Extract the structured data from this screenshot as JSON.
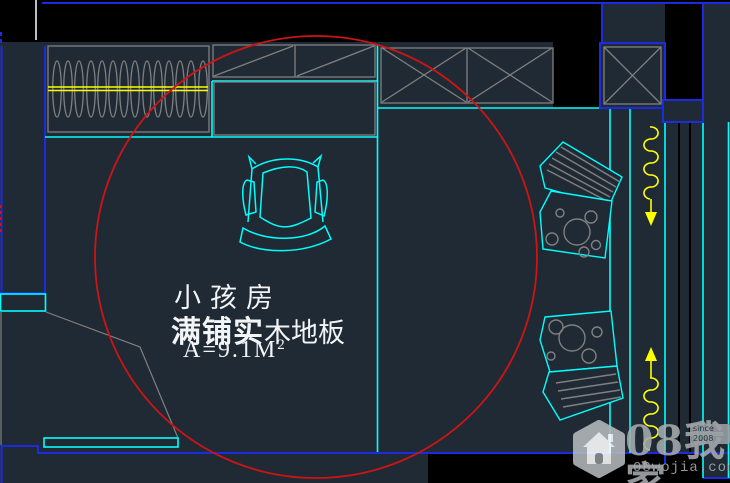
{
  "drawing": {
    "room_label": "小孩房",
    "floor_material_bold": "满铺实",
    "floor_material_rest": "木地板",
    "area_value": "A=9.1M",
    "area_exponent": "2"
  },
  "watermark": {
    "brand": "08我家",
    "site": "08wojia.com",
    "badge": "since 2008"
  },
  "icons": {
    "watermark_logo": "house-icon"
  },
  "colors": {
    "background": "#000000",
    "floor": "#1f2a35",
    "wall_blue": "#1c2ae0",
    "detail_cyan": "#00ffff",
    "furniture_gray": "#808080",
    "curtain_yellow": "#ffff00",
    "highlight_red": "#cf1414",
    "text_white": "#f2f4f6",
    "watermark_gray": "#a7abae"
  }
}
